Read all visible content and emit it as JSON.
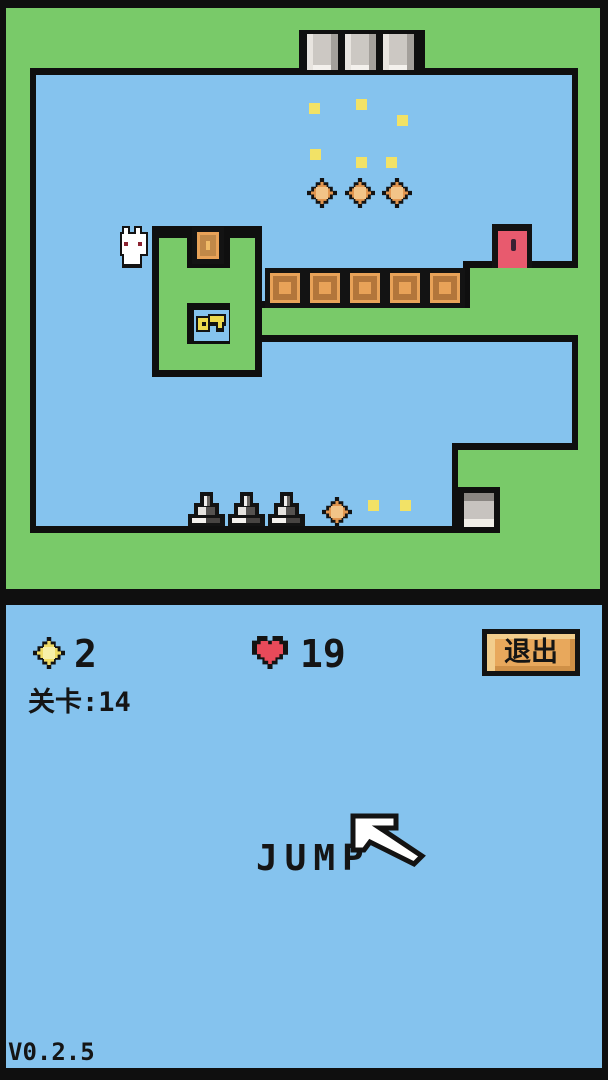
{
  "hud": {
    "coins": "2",
    "hearts": "19",
    "exit_button": "退出",
    "level_text": "关卡:14",
    "jump_label": "JUMP",
    "version": "V0.2.5"
  },
  "level": {
    "player": "white-rabbit",
    "pickups": {
      "orange_coins": 4,
      "yellow_sparkles": 8,
      "key": 1
    },
    "hazards": {
      "stone_spikes": 3
    },
    "objects": {
      "crates": 6,
      "stone_pillars": 3,
      "stone_block": 1,
      "exit_door": 1
    }
  },
  "colors": {
    "sky": "#85c3ee",
    "grass": "#79ca69",
    "outline": "#0f0f0f",
    "crate_orange": "#e8a258",
    "coin_orange": "#e2964f",
    "sparkle_yellow": "#f2e266",
    "door_red": "#e85a6e",
    "heart_red": "#e84a5a",
    "button_orange": "#e8a85c",
    "stone_gray": "#c7c3bf"
  }
}
